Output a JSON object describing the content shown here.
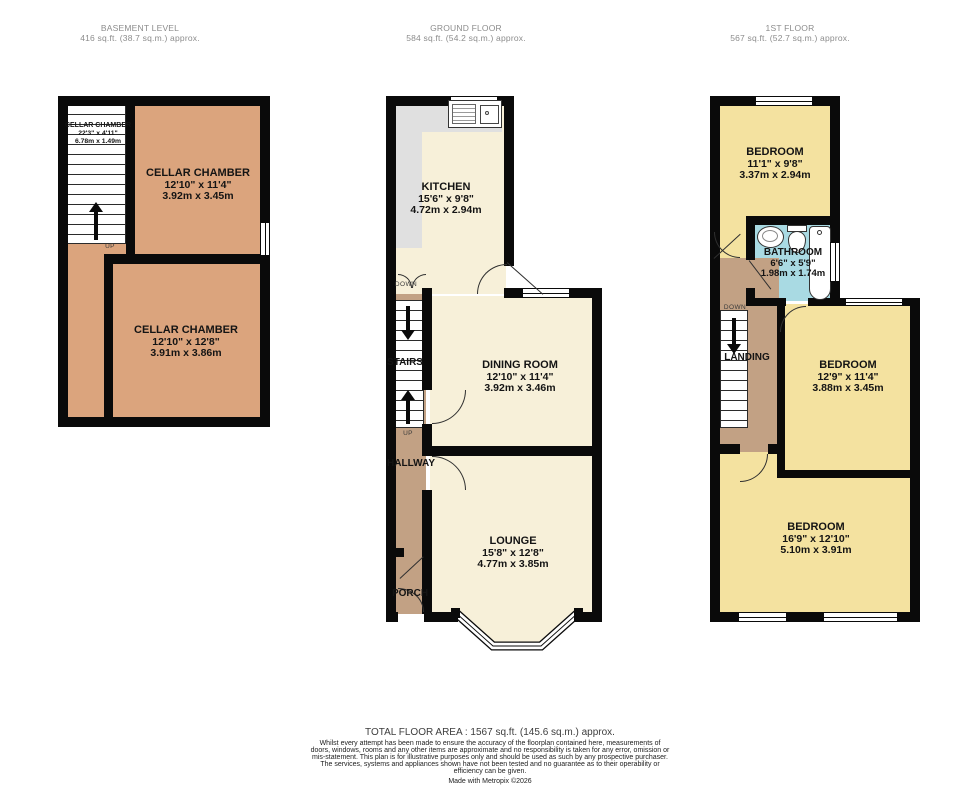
{
  "floors": {
    "basement": {
      "title": "BASEMENT LEVEL",
      "area": "416 sq.ft. (38.7 sq.m.) approx.",
      "rooms": {
        "cellar_small": {
          "name": "CELLAR CHAMBER",
          "imperial": "22'3\" x 4'11\"",
          "metric": "6.78m x 1.49m"
        },
        "cellar_top": {
          "name": "CELLAR CHAMBER",
          "imperial": "12'10\" x 11'4\"",
          "metric": "3.92m x 3.45m"
        },
        "cellar_bottom": {
          "name": "CELLAR CHAMBER",
          "imperial": "12'10\" x 12'8\"",
          "metric": "3.91m x 3.86m"
        }
      },
      "labels": {
        "up": "UP"
      }
    },
    "ground": {
      "title": "GROUND FLOOR",
      "area": "584 sq.ft. (54.2 sq.m.) approx.",
      "rooms": {
        "kitchen": {
          "name": "KITCHEN",
          "imperial": "15'6\" x 9'8\"",
          "metric": "4.72m x 2.94m"
        },
        "dining": {
          "name": "DINING ROOM",
          "imperial": "12'10\" x 11'4\"",
          "metric": "3.92m x 3.46m"
        },
        "lounge": {
          "name": "LOUNGE",
          "imperial": "15'8\" x 12'8\"",
          "metric": "4.77m x 3.85m"
        }
      },
      "labels": {
        "stairs": "STAIRS",
        "hallway": "HALLWAY",
        "porch": "PORCH",
        "up": "UP",
        "down": "DOWN"
      }
    },
    "first": {
      "title": "1ST FLOOR",
      "area": "567 sq.ft. (52.7 sq.m.) approx.",
      "rooms": {
        "bedroom_rear": {
          "name": "BEDROOM",
          "imperial": "11'1\" x 9'8\"",
          "metric": "3.37m x 2.94m"
        },
        "bathroom": {
          "name": "BATHROOM",
          "imperial": "6'6\" x 5'9\"",
          "metric": "1.98m x 1.74m"
        },
        "bedroom_middle": {
          "name": "BEDROOM",
          "imperial": "12'9\" x 11'4\"",
          "metric": "3.88m x 3.45m"
        },
        "bedroom_front": {
          "name": "BEDROOM",
          "imperial": "16'9\" x 12'10\"",
          "metric": "5.10m x 3.91m"
        }
      },
      "labels": {
        "landing": "LANDING",
        "down": "DOWN"
      }
    }
  },
  "footer": {
    "total": "TOTAL FLOOR AREA : 1567 sq.ft. (145.6 sq.m.) approx.",
    "disclaimer": "Whilst every attempt has been made to ensure the accuracy of the floorplan contained here, measurements of doors, windows, rooms and any other items are approximate and no responsibility is taken for any error, omission or mis-statement. This plan is for illustrative purposes only and should be used as such by any prospective purchaser. The services, systems and appliances shown have not been tested and no guarantee as to their operability or efficiency can be given.",
    "credit": "Made with Metropix ©2026"
  },
  "colors": {
    "wall": "#0a0a0a",
    "cellar_room": "#dba47d",
    "living_room": "#f7f0d9",
    "circulation": "#c2a184",
    "bedroom": "#f4e2a0",
    "bathroom": "#a9dae3",
    "counter": "#e0e0e0",
    "header_text": "#8c8c8c"
  }
}
